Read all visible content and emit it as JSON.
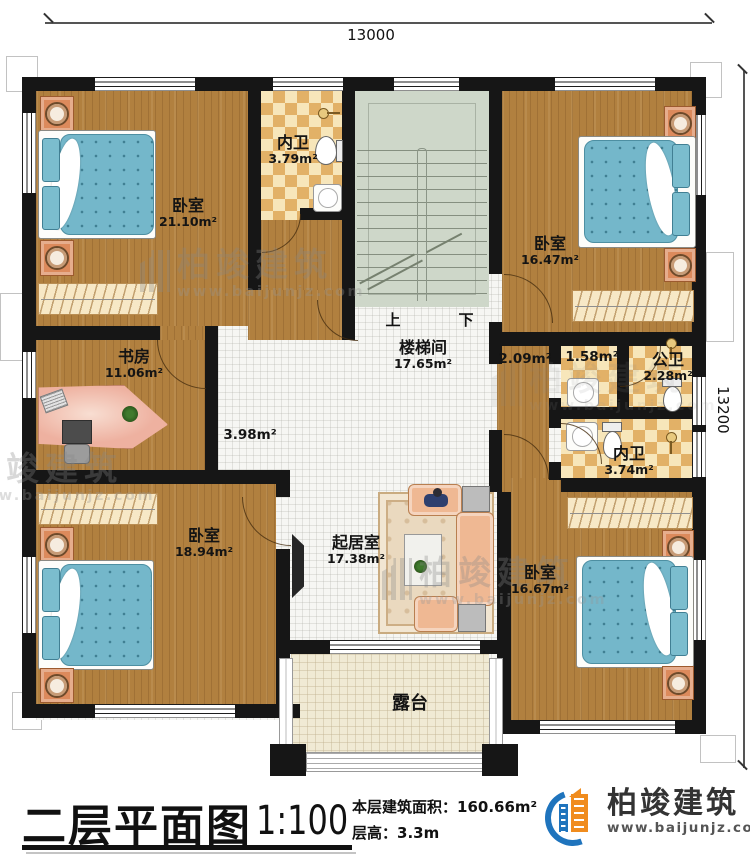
{
  "dimensions": {
    "top": "13000",
    "right": "13200"
  },
  "stairs": {
    "up": "上",
    "down": "下"
  },
  "rooms": {
    "bedroom_tl": {
      "name": "卧室",
      "area": "21.10m²"
    },
    "bath_top": {
      "name": "内卫",
      "area": "3.79m²"
    },
    "bedroom_tr": {
      "name": "卧室",
      "area": "16.47m²"
    },
    "study": {
      "name": "书房",
      "area": "11.06m²"
    },
    "stairwell": {
      "name": "楼梯间",
      "area": "17.65m²"
    },
    "hall": {
      "area": "3.98m²"
    },
    "landing": {
      "area": "2.09m²"
    },
    "bath_lobby": {
      "area": "1.58m²"
    },
    "public_bath": {
      "name": "公卫",
      "area": "2.28m²"
    },
    "bath_right": {
      "name": "内卫",
      "area": "3.74m²"
    },
    "bedroom_bl": {
      "name": "卧室",
      "area": "18.94m²"
    },
    "living": {
      "name": "起居室",
      "area": "17.38m²"
    },
    "bedroom_br": {
      "name": "卧室",
      "area": "16.67m²"
    },
    "terrace": {
      "name": "露台"
    }
  },
  "titleblock": {
    "title": "二层平面图",
    "scale": "1:100",
    "area_label": "本层建筑面积：",
    "area_value": "160.66m²",
    "height_label": "层高：",
    "height_value": "3.3m"
  },
  "brand": {
    "name": "柏竣建筑",
    "url": "www.baijunjz.com"
  },
  "watermark": {
    "name": "柏竣建筑",
    "url": "www.baijunjz.com"
  },
  "colors": {
    "wall": "#161616",
    "wood_floor": "#b1803f",
    "bath_tile": "#e2b167",
    "stair": "#ced7c9",
    "bed_blue": "#74b7ca",
    "logo_blue": "#1f74bd",
    "logo_orange": "#f08c1e",
    "terrace": "#f0ead4"
  }
}
